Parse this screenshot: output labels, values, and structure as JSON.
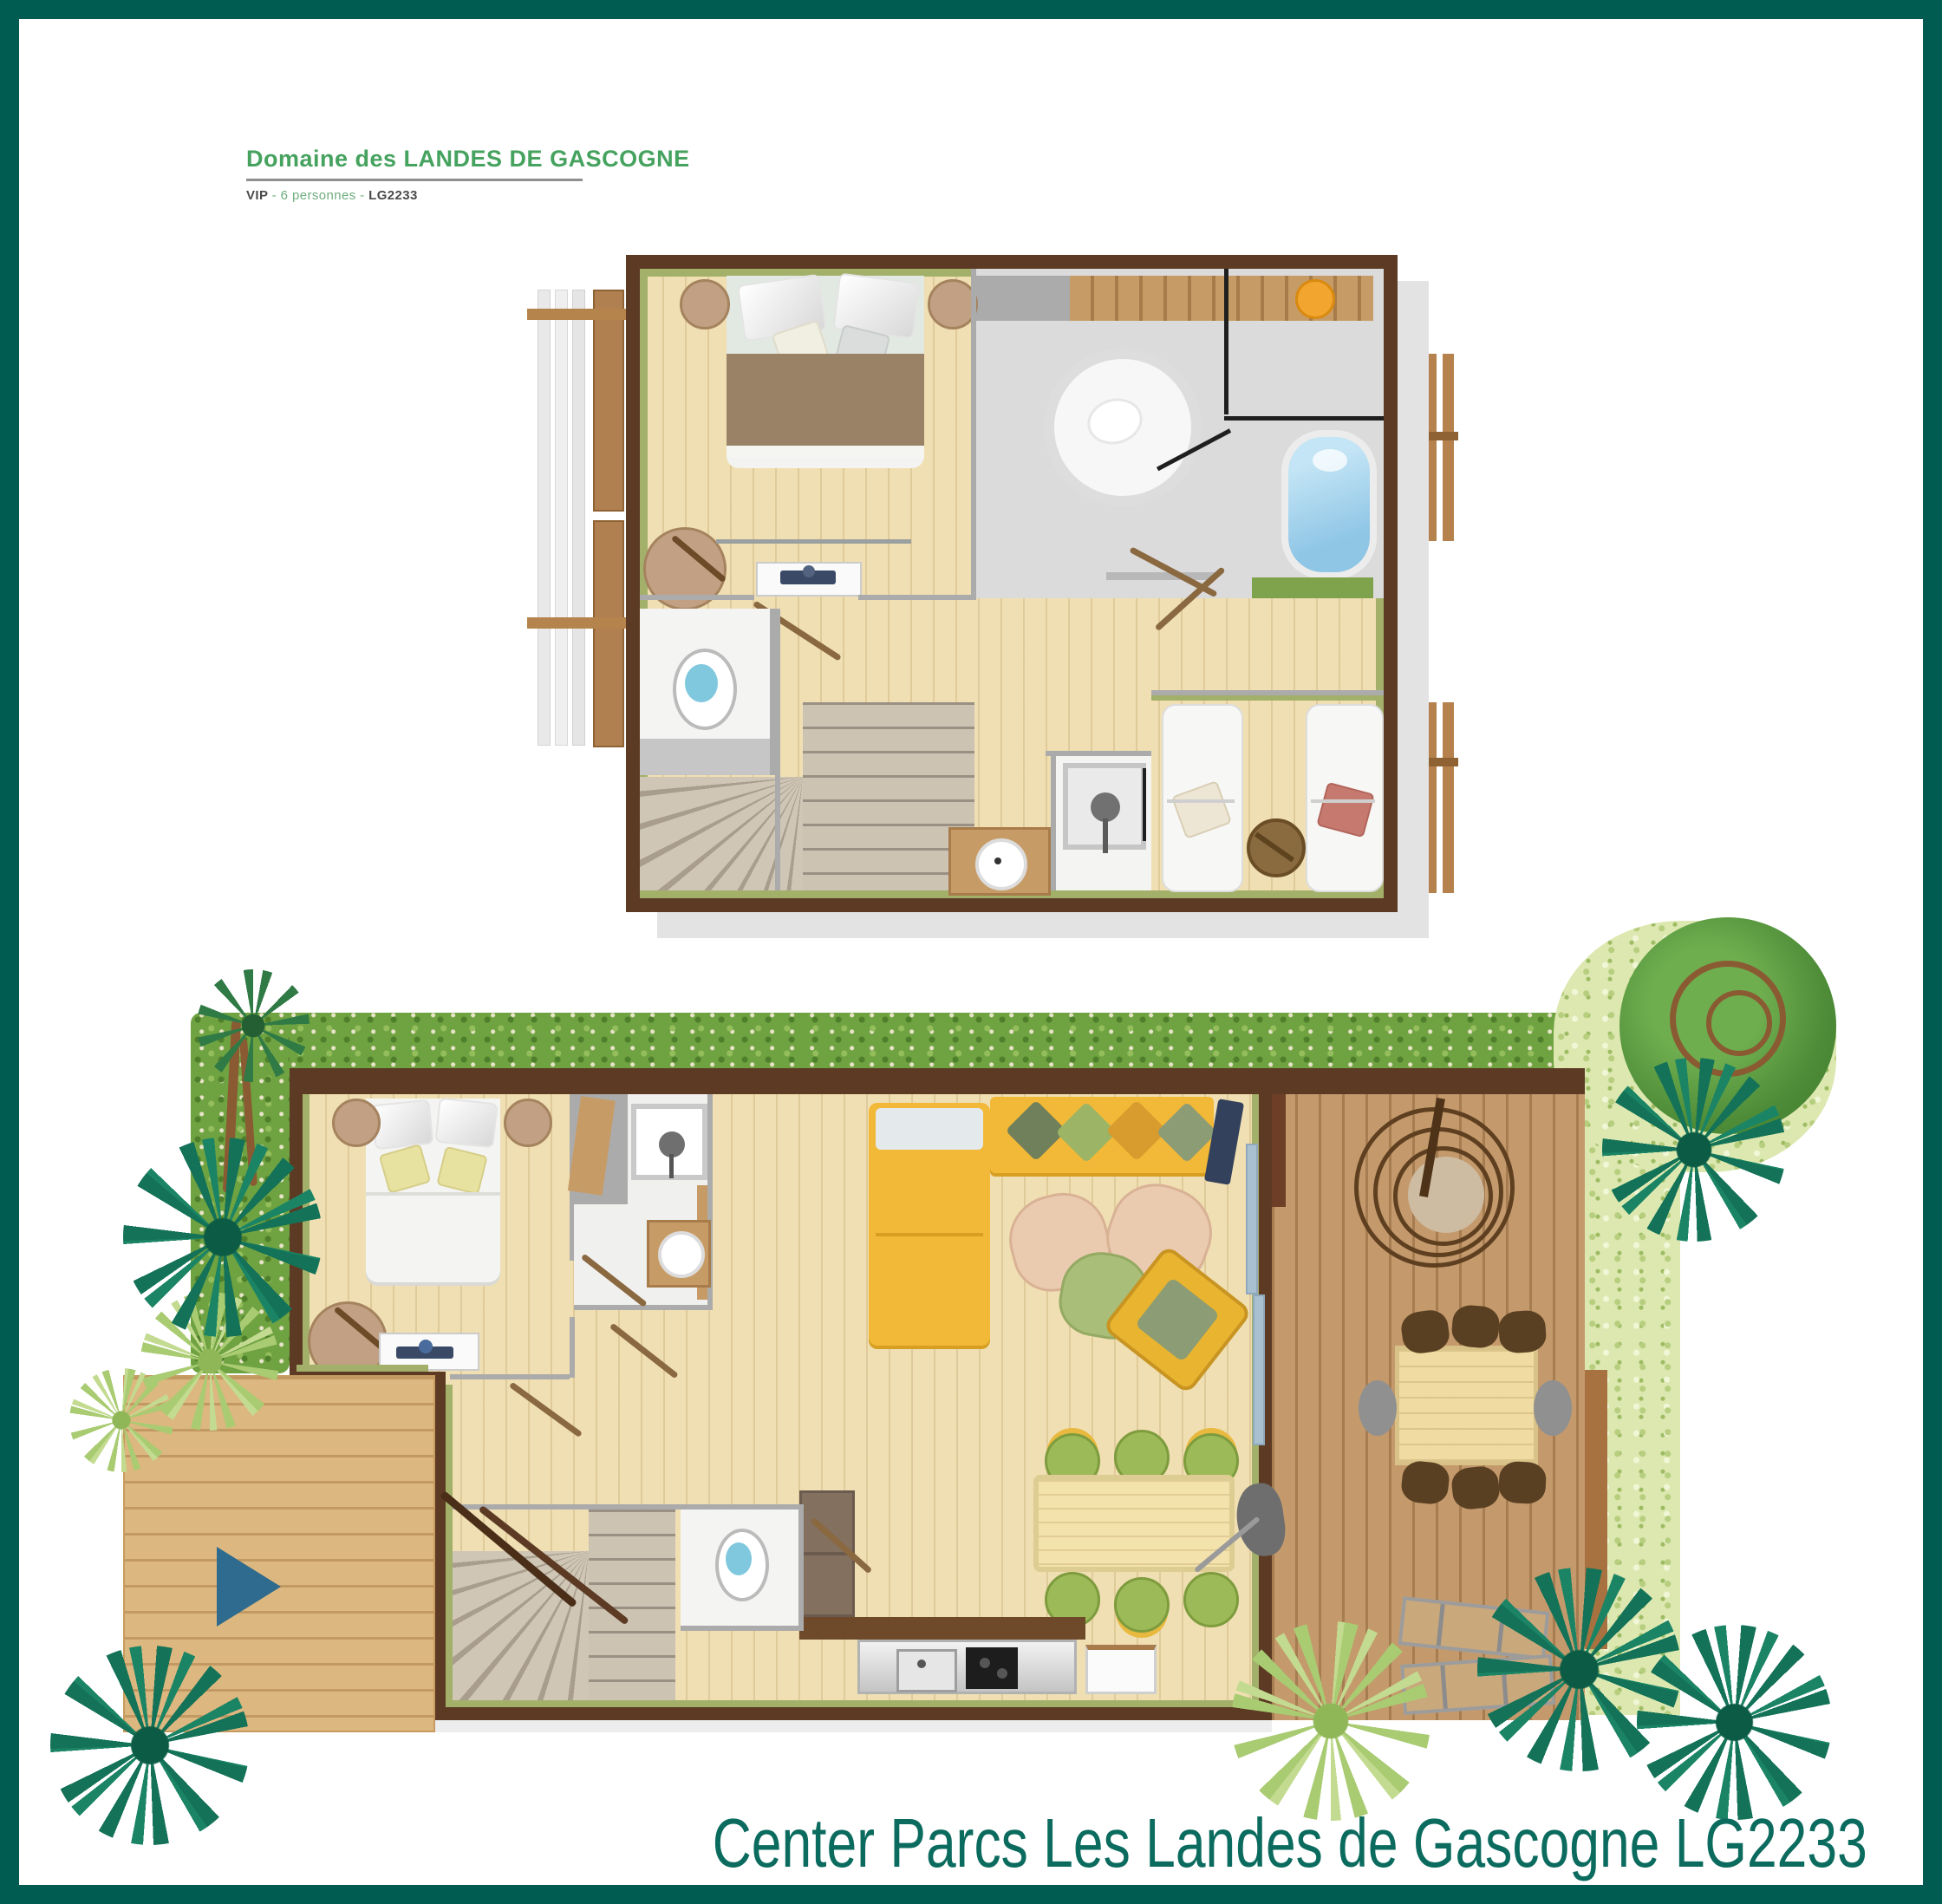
{
  "header": {
    "brand": "Domaine des LANDES DE GASCOGNE",
    "subtitle_prefix": "VIP",
    "subtitle_mid": "- 6 personnes -",
    "subtitle_code": "LG2233"
  },
  "footer": {
    "caption": "Center Parcs Les Landes de Gascogne LG2233"
  },
  "colors": {
    "frame_teal": "#005B50",
    "caption_teal": "#0B6B5E",
    "brand_green": "#46A25F",
    "wall_brown": "#5C3A24",
    "olive_trim": "#A3B06A",
    "wood_floor": "#EFDFB2",
    "terrace_wood": "#C49A6C",
    "deck_wood": "#DCB77F",
    "hedge_green": "#6FA241",
    "hedge_light": "#DCE8B0",
    "palm_teal": "#137257",
    "sofa_yellow": "#F2B838",
    "bathtub_blue": "#8FC6E6",
    "toilet_blue": "#7FC8DE",
    "arrow_blue": "#2E6B8E"
  },
  "floors": {
    "upper": {
      "name": "upper-floor-plan",
      "features": [
        "double-bed",
        "nightstands",
        "dresser-tv",
        "bathroom-round-shower",
        "bathtub",
        "closet",
        "toilet-room",
        "winder-stairs",
        "shower-stall",
        "washbasin",
        "two-single-beds",
        "stool",
        "balcony-fences"
      ]
    },
    "ground": {
      "name": "ground-floor-plan",
      "features": [
        "double-bed",
        "nightstands",
        "dresser",
        "shower-room",
        "washbasin",
        "corner-sofa",
        "chaise",
        "tv",
        "pouffes",
        "armchair",
        "dining-table-six-chairs",
        "kitchen-counter",
        "winder-stairs",
        "toilet-room",
        "terrace-hanging-chair",
        "outdoor-dining-table",
        "sun-loungers",
        "garden-hedges",
        "palm-trees",
        "entrance-deck"
      ]
    }
  }
}
